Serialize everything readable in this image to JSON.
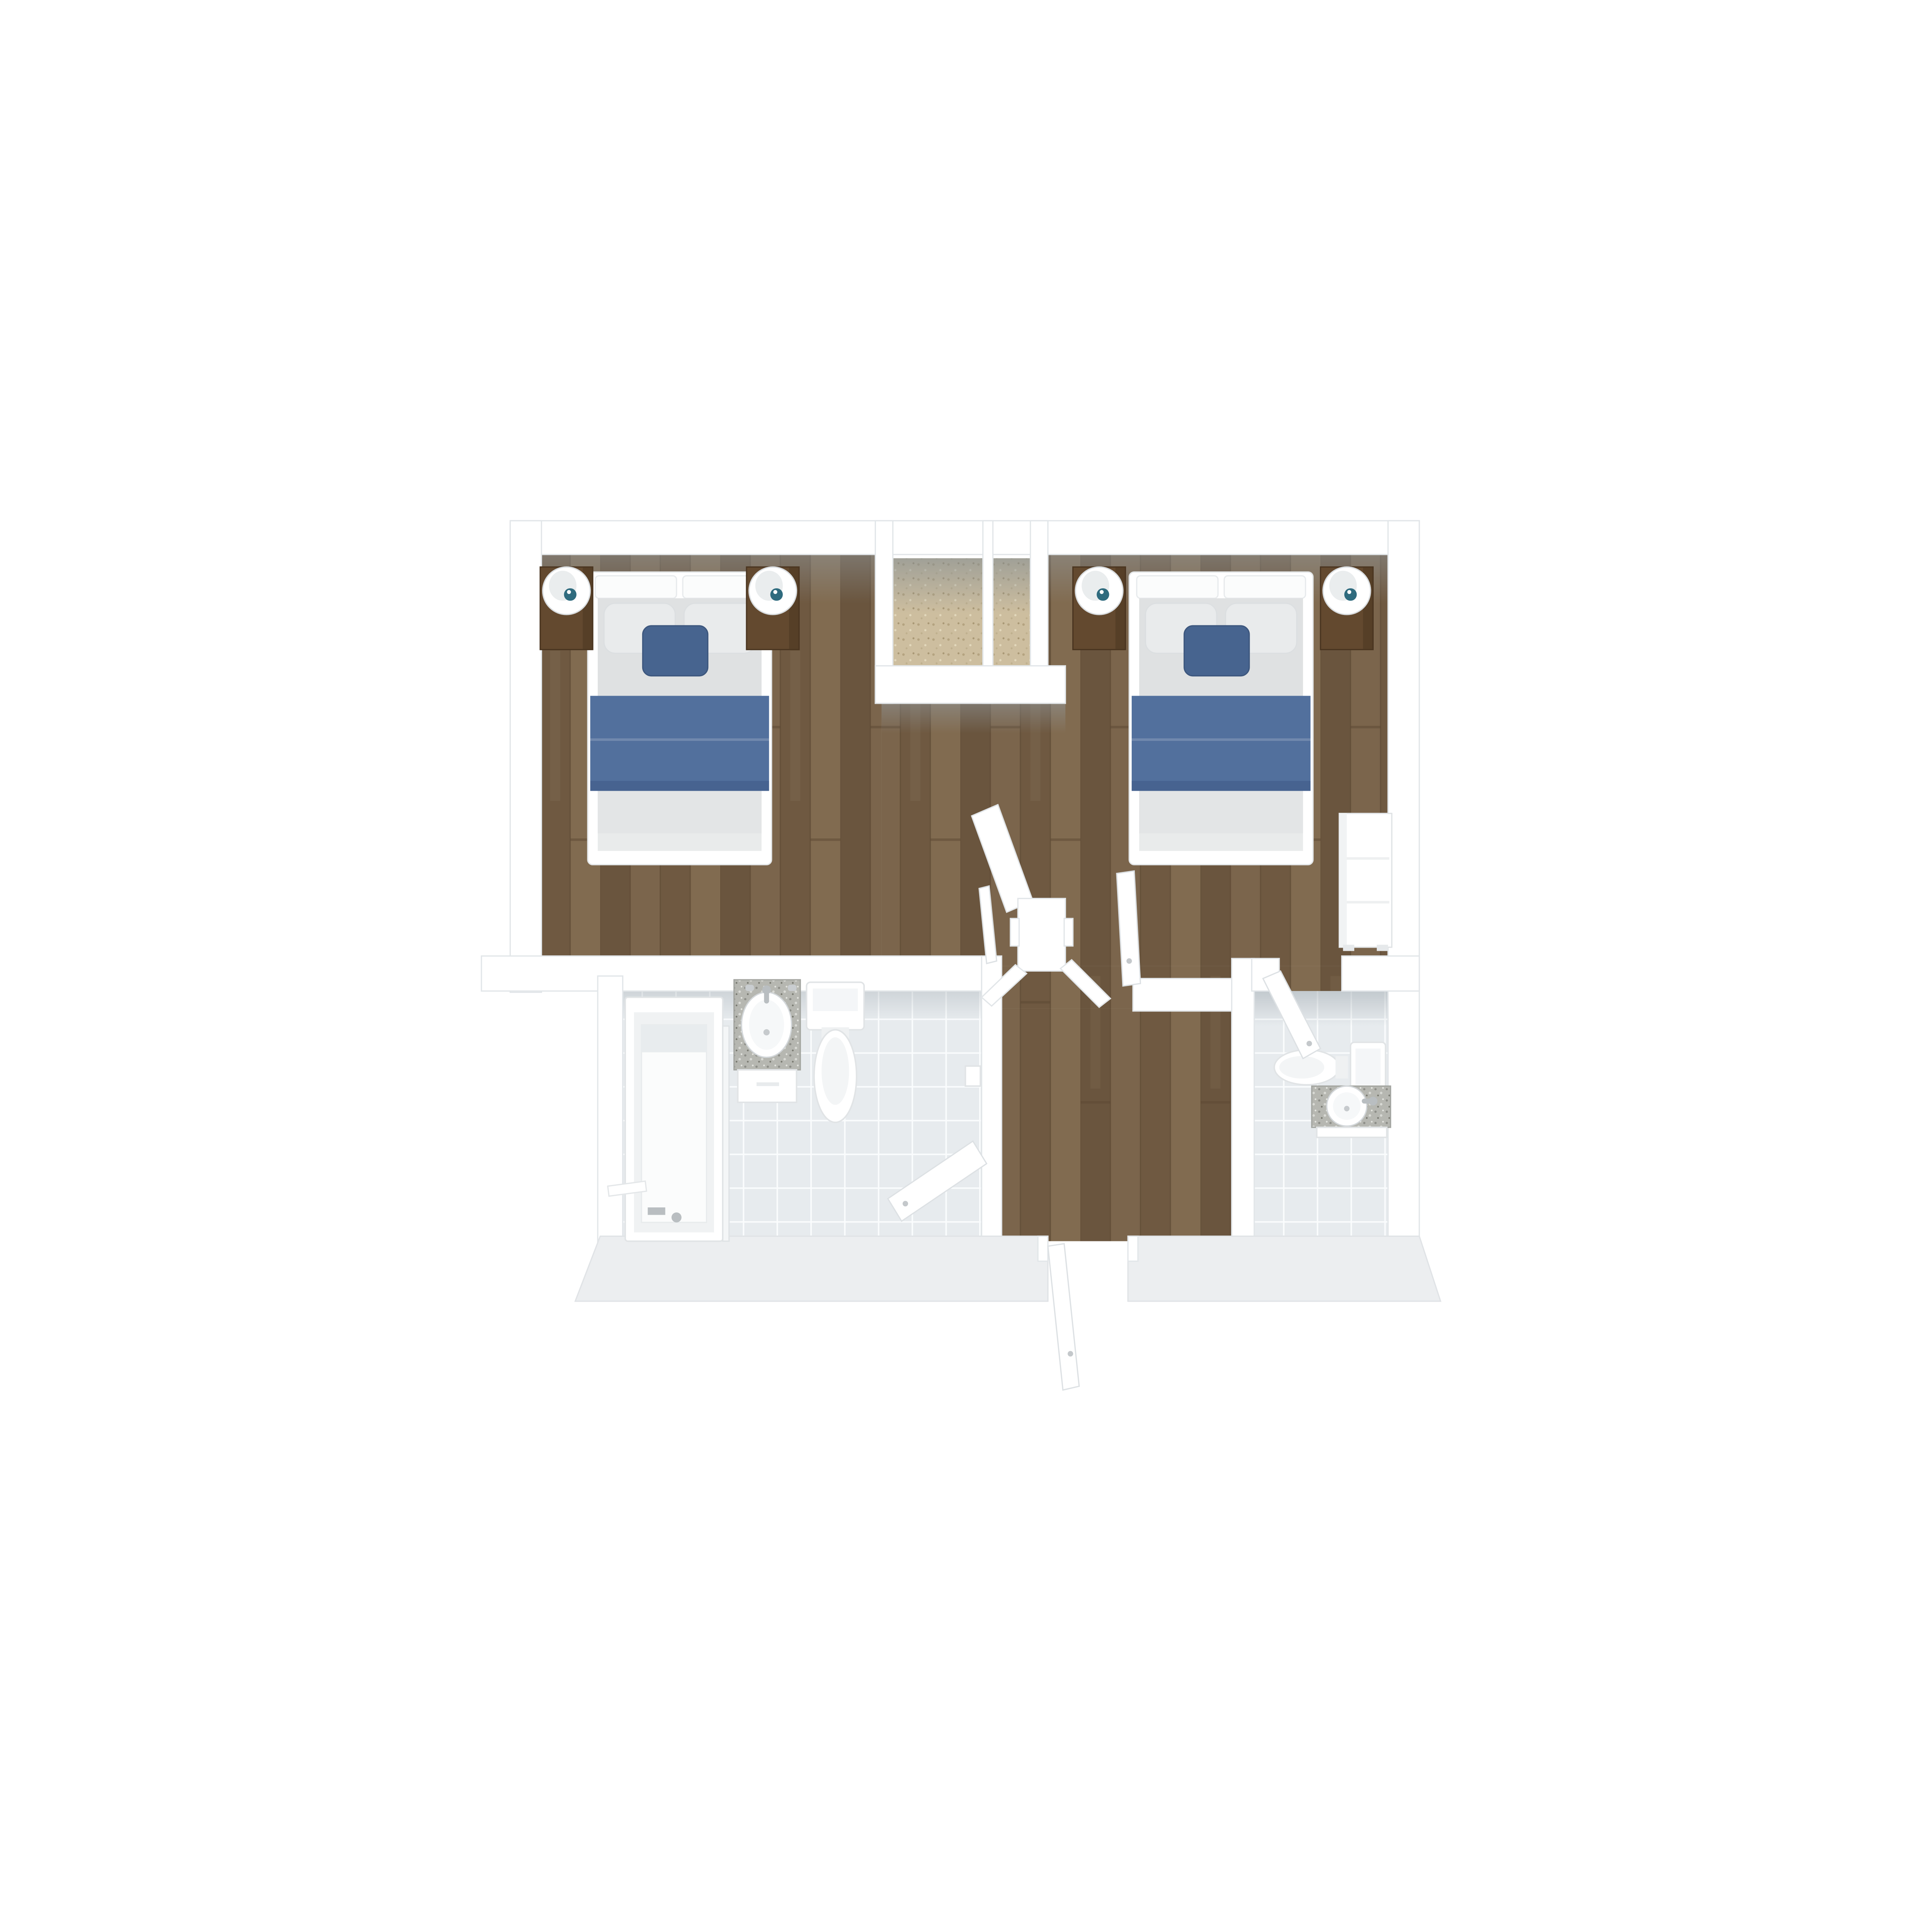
{
  "scene": {
    "kind": "floor-plan-3d-top-view",
    "description": "Top-down 3D rendered floor plan: two bedrooms with beds at top, two carpeted closets between them, central hallway with open doors, bathroom with tub at bottom left, bathroom with toilet and sink at bottom right, exit door at bottom center",
    "rooms": [
      {
        "id": "bedroom-left",
        "floor": "wood"
      },
      {
        "id": "closet-left",
        "floor": "carpet"
      },
      {
        "id": "closet-right",
        "floor": "carpet"
      },
      {
        "id": "bedroom-right",
        "floor": "wood"
      },
      {
        "id": "hallway",
        "floor": "wood"
      },
      {
        "id": "bathroom-left",
        "floor": "tile"
      },
      {
        "id": "bathroom-right",
        "floor": "tile"
      }
    ],
    "furniture": [
      {
        "id": "double-bed",
        "count": 2,
        "parts": [
          "white-frame",
          "split-headboard",
          "gray-mattress",
          "two-gray-pillows",
          "blue-accent-pillow",
          "blue-blanket"
        ]
      },
      {
        "id": "nightstand",
        "count": 4,
        "material": "dark-walnut"
      },
      {
        "id": "table-lamp",
        "count": 4,
        "style": "white-egg-shade-teal-finial"
      },
      {
        "id": "dresser",
        "count": 1,
        "material": "white"
      },
      {
        "id": "bathtub",
        "count": 1
      },
      {
        "id": "shower-screen",
        "count": 1
      },
      {
        "id": "vanity-sink",
        "count": 2,
        "material": "granite-top"
      },
      {
        "id": "toilet",
        "count": 2
      },
      {
        "id": "towel-bar",
        "count": 1
      },
      {
        "id": "open-door",
        "count": 5,
        "positions": [
          "bedroom-left",
          "bedroom-right",
          "bathroom-left",
          "bathroom-right",
          "hall-exit-bottom"
        ]
      }
    ],
    "colors": {
      "background": "#ffffff",
      "wall": "#ffffff",
      "wall_edge": "#e2e6e9",
      "bottom_wall_face": "#eceef0",
      "wood_base": "#725d46",
      "wood_dark": "#6a553e",
      "wood_mid": "#6f5941",
      "wood_light": "#7b654c",
      "wood_lighter": "#816b50",
      "wood_seam": "#5b4732",
      "carpet": "#cdbe9f",
      "carpet_dark": "#b4a380",
      "carpet_light": "#e2d8bc",
      "tile": "#e7ebee",
      "grout": "#fafcfd",
      "blanket": "#52709d",
      "accent_pillow": "#47648f",
      "pillow": "#e9ebec",
      "mattress": "#dfe1e2",
      "mattress_low": "#e3e5e6",
      "bed_frame": "#ffffff",
      "nightstand": "#63492f",
      "nightstand_edge": "#4a3520",
      "lamp_shade": "#ffffff",
      "lamp_inner": "#eaedee",
      "lamp_finial": "#2f6b7e",
      "granite": "#b6b7b1",
      "granite_dark": "#8d8e88",
      "granite_light": "#d8d9d4",
      "chrome": "#b9bec1",
      "fixture_edge": "#e1e4e6"
    }
  }
}
